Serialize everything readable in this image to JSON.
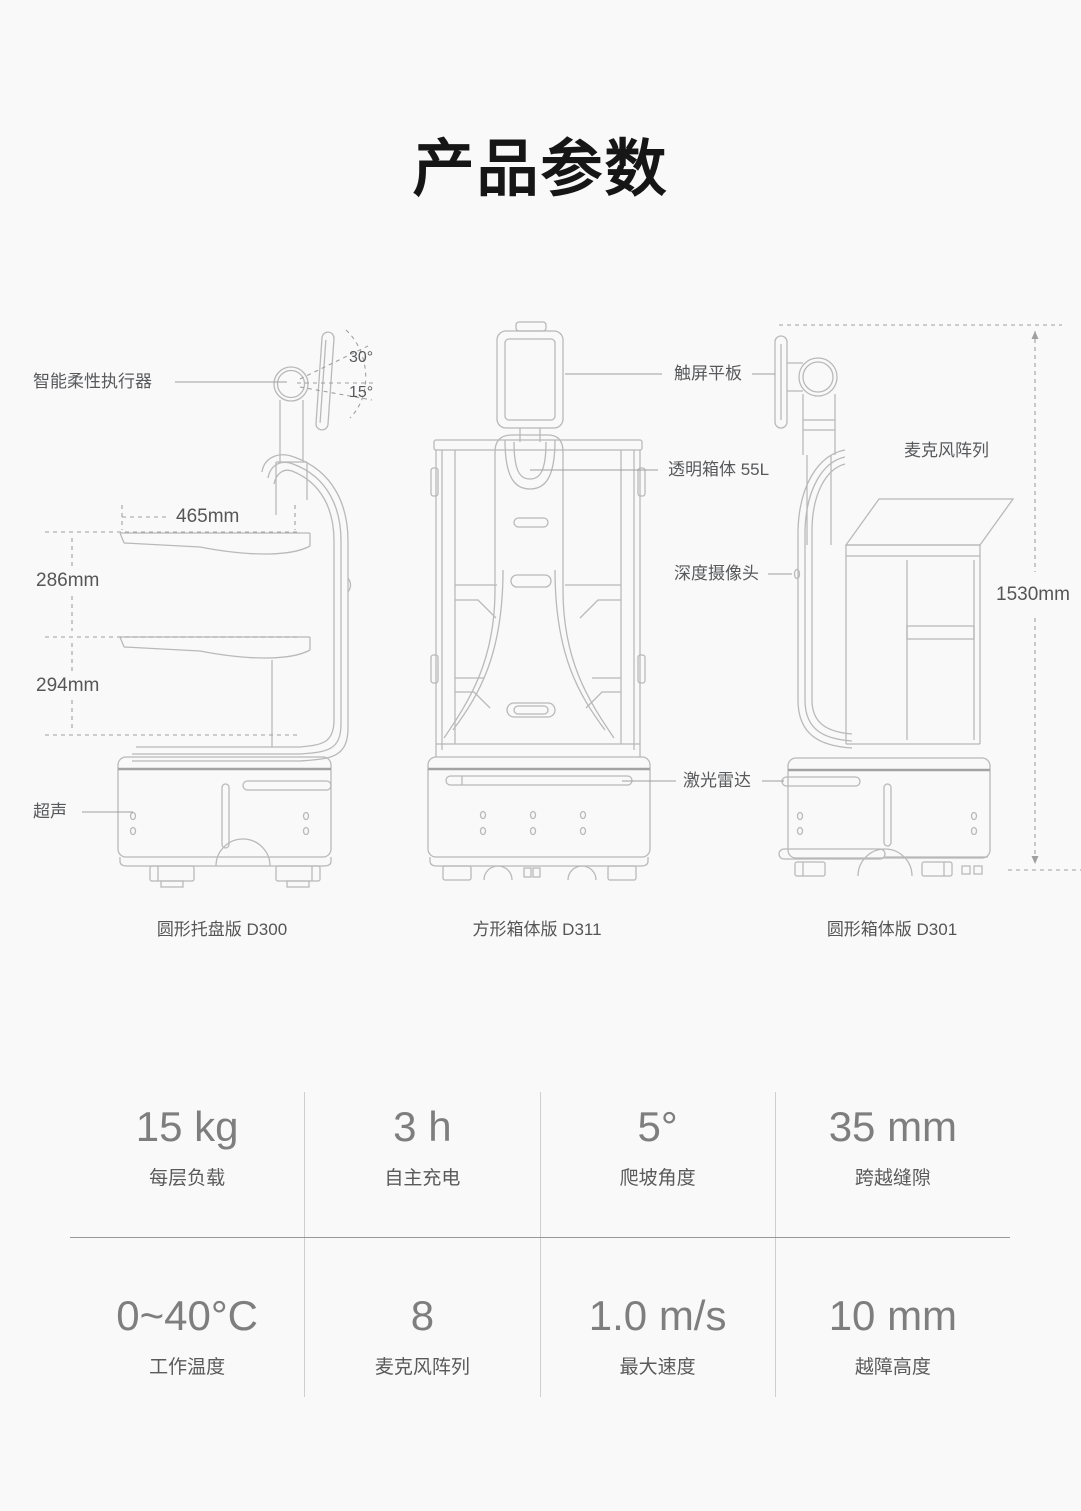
{
  "title": "产品参数",
  "diagram": {
    "annotations": {
      "actuator": "智能柔性执行器",
      "angle_up": "30°",
      "angle_down": "15°",
      "tray_width": "465mm",
      "gap_upper": "286mm",
      "gap_lower": "294mm",
      "ultrasonic": "超声",
      "touchscreen": "触屏平板",
      "transparent_box": "透明箱体 55L",
      "depth_camera": "深度摄像头",
      "lidar": "激光雷达",
      "mic_array": "麦克风阵列",
      "total_height": "1530mm"
    },
    "captions": [
      "圆形托盘版 D300",
      "方形箱体版 D311",
      "圆形箱体版 D301"
    ]
  },
  "specs": [
    {
      "value": "15 kg",
      "label": "每层负载"
    },
    {
      "value": "3 h",
      "label": "自主充电"
    },
    {
      "value": "5°",
      "label": "爬坡角度"
    },
    {
      "value": "35 mm",
      "label": "跨越缝隙"
    },
    {
      "value": "0~40°C",
      "label": "工作温度"
    },
    {
      "value": "8",
      "label": "麦克风阵列"
    },
    {
      "value": "1.0 m/s",
      "label": "最大速度"
    },
    {
      "value": "10 mm",
      "label": "越障高度"
    }
  ],
  "colors": {
    "background": "#f9f9f9",
    "line_art": "#b9b9b9",
    "annotation_text": "#58595b",
    "spec_value": "#7e7e7e",
    "title_text": "#161616"
  }
}
